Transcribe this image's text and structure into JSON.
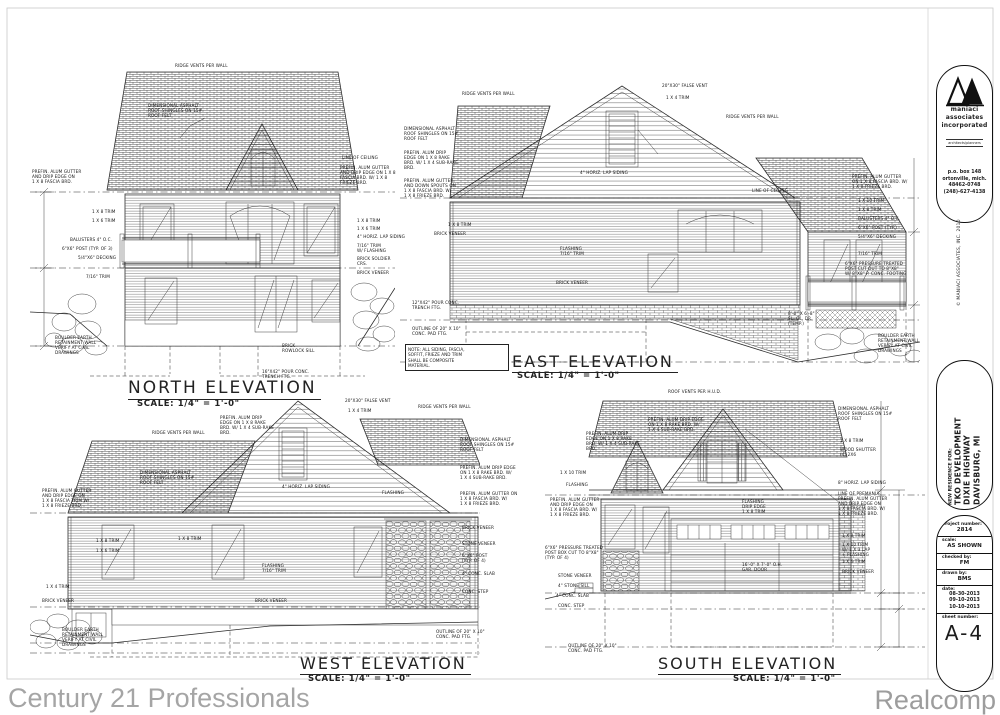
{
  "sheet": {
    "elevations": [
      {
        "id": "north",
        "title": "NORTH ELEVATION",
        "scale": "SCALE: 1/4\" = 1'-0\""
      },
      {
        "id": "east",
        "title": "EAST ELEVATION",
        "scale": "SCALE: 1/4\" = 1'-0\""
      },
      {
        "id": "west",
        "title": "WEST ELEVATION",
        "scale": "SCALE: 1/4\" = 1'-0\""
      },
      {
        "id": "south",
        "title": "SOUTH ELEVATION",
        "scale": "SCALE: 1/4\" = 1'-0\""
      }
    ],
    "note": "NOTE: ALL SIDING, FASCIA,\nSOFFIT, FRIEZE AND TRIM\nSHALL BE COMPOSITE\nMATERIAL."
  },
  "annotations": {
    "north": [
      {
        "t": "RIDGE VENTS PER WALL",
        "x": 175,
        "y": 64
      },
      {
        "t": "DIMENSIONAL ASPHALT\nROOF SHINGLES ON 15#\nROOF FELT",
        "x": 148,
        "y": 104
      },
      {
        "t": "LINE OF CEILING",
        "x": 342,
        "y": 156
      },
      {
        "t": "PREFIN. ALUM GUTTER\nAND DRIP EDGE ON 1 X 8\nFASCIA BRD. W/ 1 X 8\nFRIEZE BRD.",
        "x": 340,
        "y": 166
      },
      {
        "t": "PREFIN. ALUM GUTTER\nAND DRIP EDGE ON\n1 X 8 FASCIA BRD.",
        "x": 32,
        "y": 170
      },
      {
        "t": "1 X 8 TRIM",
        "x": 92,
        "y": 210
      },
      {
        "t": "1 X 6 TRIM",
        "x": 92,
        "y": 219
      },
      {
        "t": "BALUSTERS 4\" O.C.",
        "x": 70,
        "y": 238
      },
      {
        "t": "6\"X6\" POST (TYP. OF 3)",
        "x": 62,
        "y": 247
      },
      {
        "t": "5/4\"X6\" DECKING",
        "x": 78,
        "y": 256
      },
      {
        "t": "7/16\" TRIM",
        "x": 86,
        "y": 275
      },
      {
        "t": "1 X 8 TRIM",
        "x": 357,
        "y": 219
      },
      {
        "t": "1 X 6 TRIM",
        "x": 357,
        "y": 227
      },
      {
        "t": "4\" HORIZ. LAP SIDING",
        "x": 357,
        "y": 235
      },
      {
        "t": "7/16\" TRIM\nW/ FLASHING",
        "x": 357,
        "y": 244
      },
      {
        "t": "BRICK SOLDIER\nCRS.",
        "x": 357,
        "y": 257
      },
      {
        "t": "BRICK VENEER",
        "x": 357,
        "y": 271
      },
      {
        "t": "BRICK\nROWLOCK SILL",
        "x": 282,
        "y": 344
      },
      {
        "t": "16\"X42\" POUR CONC.\nTRENCH FTG.",
        "x": 262,
        "y": 370
      },
      {
        "t": "BOULDER EARTH\nRETAINMENT WALL\nVERIFY AT CIVIL\nDRAWINGS",
        "x": 55,
        "y": 336
      }
    ],
    "east": [
      {
        "t": "RIDGE VENTS PER WALL",
        "x": 462,
        "y": 92
      },
      {
        "t": "20\"X30\" FALSE VENT",
        "x": 662,
        "y": 84
      },
      {
        "t": "1 X 4 TRIM",
        "x": 666,
        "y": 96
      },
      {
        "t": "RIDGE VENTS PER WALL",
        "x": 726,
        "y": 115
      },
      {
        "t": "DIMENSIONAL ASPHALT\nROOF SHINGLES ON 15#\nROOF FELT",
        "x": 404,
        "y": 127
      },
      {
        "t": "PREFIN. ALUM DRIP\nEDGE ON 1 X 8 RAKE\nBRD. W/ 1 X 4 SUB-RAKE\nBRD.",
        "x": 404,
        "y": 151
      },
      {
        "t": "PREFIN. ALUM GUTTER\nAND DOWN SPOUTS ON\n1 X 8 FASCIA BRD. W/\n1 X 8 FRIEZE BRD.",
        "x": 404,
        "y": 179
      },
      {
        "t": "4\" HORIZ. LAP SIDING",
        "x": 580,
        "y": 171
      },
      {
        "t": "LINE OF CEILING",
        "x": 752,
        "y": 189
      },
      {
        "t": "1 X 8 TRIM",
        "x": 448,
        "y": 223
      },
      {
        "t": "BRICK VENEER",
        "x": 434,
        "y": 232
      },
      {
        "t": "FLASHING\n7/16\" TRIM",
        "x": 560,
        "y": 247
      },
      {
        "t": "BRICK VENEER",
        "x": 556,
        "y": 281
      },
      {
        "t": "12\"X42\" POUR CONC.\nTRENCH FTG.",
        "x": 412,
        "y": 301
      },
      {
        "t": "OUTLINE OF 20\" X 10\"\nCONC. PAD FTG.",
        "x": 412,
        "y": 327
      },
      {
        "t": "PREFIN. ALUM GUTTER\nON 1 X 8 FASCIA BRD. W/\n1 X 8 FRIEZE BRD.",
        "x": 852,
        "y": 175
      },
      {
        "t": "1 X 10 TRIM",
        "x": 858,
        "y": 199
      },
      {
        "t": "1 X 8 TRIM",
        "x": 858,
        "y": 208
      },
      {
        "t": "BALUSTERS 4\" O.C.",
        "x": 858,
        "y": 217
      },
      {
        "t": "6\"X6\" POST (TYP.)",
        "x": 858,
        "y": 226
      },
      {
        "t": "5/4\"X6\" DECKING",
        "x": 858,
        "y": 235
      },
      {
        "t": "7/16\" TRIM",
        "x": 858,
        "y": 252
      },
      {
        "t": "6\"X6\" PRESSURE TREATED\nPOST CUT OUT TO 8\"X8\"\nW/ 8\"X8\" P. CONC. FOOTING",
        "x": 845,
        "y": 262
      },
      {
        "t": "8'-0\" X 6'-8\"\nSL. GL. DR.\n(TEMP.)",
        "x": 788,
        "y": 312
      },
      {
        "t": "BOULDER EARTH\nRETAINMENT WALL\nVERIFY AT CIVIL\nDRAWINGS",
        "x": 878,
        "y": 334
      }
    ],
    "west": [
      {
        "t": "RIDGE VENTS PER WALL",
        "x": 152,
        "y": 431
      },
      {
        "t": "PREFIN. ALUM DRIP\nEDGE ON 1 X 8 RAKE\nBRD. W/ 1 X 4 SUB-RAKE\nBRD.",
        "x": 220,
        "y": 416
      },
      {
        "t": "20\"X30\" FALSE VENT",
        "x": 345,
        "y": 399
      },
      {
        "t": "1 X 4 TRIM",
        "x": 348,
        "y": 409
      },
      {
        "t": "RIDGE VENTS PER WALL",
        "x": 418,
        "y": 405
      },
      {
        "t": "DIMENSIONAL ASPHALT\nROOF SHINGLES ON 15#\nROOF FELT",
        "x": 140,
        "y": 471
      },
      {
        "t": "PREFIN. ALUM GUTTER\nAND DRIP EDGE ON\n1 X 8 FASCIA TRIM W/\n1 X 8 FRIEZE BRD.",
        "x": 42,
        "y": 489
      },
      {
        "t": "4\" HORIZ. LAP SIDING",
        "x": 282,
        "y": 485
      },
      {
        "t": "FLASHING",
        "x": 382,
        "y": 491
      },
      {
        "t": "1 X 8 TRIM",
        "x": 96,
        "y": 539
      },
      {
        "t": "1 X 6 TRIM",
        "x": 96,
        "y": 549
      },
      {
        "t": "1 X 8 TRIM",
        "x": 178,
        "y": 537
      },
      {
        "t": "FLASHING\n7/16\" TRIM",
        "x": 262,
        "y": 564
      },
      {
        "t": "BRICK VENEER",
        "x": 255,
        "y": 599
      },
      {
        "t": "1 X 4 TRIM",
        "x": 46,
        "y": 585
      },
      {
        "t": "BRICK VENEER",
        "x": 42,
        "y": 599
      },
      {
        "t": "DIMENSIONAL ASPHALT\nROOF SHINGLES ON 15#\nROOF FELT",
        "x": 460,
        "y": 438
      },
      {
        "t": "PREFIN. ALUM DRIP EDGE\nON 1 X 8 RAKE BRD. W/\n1 X 4 SUB-RAKE BRD.",
        "x": 460,
        "y": 466
      },
      {
        "t": "PREFIN. ALUM GUTTER ON\n1 X 8 FASCIA BRD. W/\n1 X 8 FRIEZE BRD.",
        "x": 460,
        "y": 492
      },
      {
        "t": "BRICK VENEER",
        "x": 462,
        "y": 526
      },
      {
        "t": "STONE VENEER",
        "x": 462,
        "y": 542
      },
      {
        "t": "6\"X6\" POST\n(TYP. OF 4)",
        "x": 462,
        "y": 554
      },
      {
        "t": "4\" CONC. SLAB",
        "x": 462,
        "y": 572
      },
      {
        "t": "CONC. STEP",
        "x": 462,
        "y": 590
      },
      {
        "t": "BOULDER EARTH\nRETAINMENT WALL\nVERIFY AT CIVIL\nDRAWINGS",
        "x": 62,
        "y": 628
      },
      {
        "t": "OUTLINE OF 20\" X 10\"\nCONC. PAD FTG.",
        "x": 436,
        "y": 630
      }
    ],
    "south": [
      {
        "t": "ROOF VENTS PER H.U.D.",
        "x": 668,
        "y": 390
      },
      {
        "t": "DIMENSIONAL ASPHALT\nROOF SHINGLES ON 15#\nROOF FELT",
        "x": 838,
        "y": 407
      },
      {
        "t": "PREFIN. ALUM DRIP\nEDGE ON 1 X 8 RAKE\nBRD. W/ 1 X 4 SUB-RAKE\nBRD.",
        "x": 586,
        "y": 432
      },
      {
        "t": "PREFIN. ALUM DRIP EDGE\nON 1 X 8 RAKE BRD. W/\n1 X 4 SUB-RAKE BRD.",
        "x": 648,
        "y": 418
      },
      {
        "t": "1 X 8 TRIM",
        "x": 840,
        "y": 439
      },
      {
        "t": "WOOD SHUTTER\n(4) 2X6",
        "x": 840,
        "y": 448
      },
      {
        "t": "8\" HORIZ. LAP SIDING",
        "x": 838,
        "y": 481
      },
      {
        "t": "LINE OF PREMANUF.\nPREFIN. ALUM GUTTER\nAND DRIP EDGE ON\n1 X 8 FASCIA BRD. W/\n1 X 8 FRIEZE BRD.",
        "x": 838,
        "y": 492
      },
      {
        "t": "1 X 10 TRIM",
        "x": 560,
        "y": 471
      },
      {
        "t": "FLASHING",
        "x": 566,
        "y": 483
      },
      {
        "t": "PREFIN. ALUM GUTTER\nAND DRIP EDGE ON\n1 X 8 FASCIA BRD. W/\n1 X 8 FRIEZE BRD.",
        "x": 550,
        "y": 498
      },
      {
        "t": "FLASHING\nDRIP EDGE\n1 X 8 TRIM",
        "x": 742,
        "y": 500
      },
      {
        "t": "1 X 8 TRIM",
        "x": 842,
        "y": 534
      },
      {
        "t": "1 X 10 TRIM\nW/ 1 X 3 LAP\n+ FLASHING",
        "x": 842,
        "y": 543
      },
      {
        "t": "1 X 6 TRIM",
        "x": 842,
        "y": 560
      },
      {
        "t": "BRICK VENEER",
        "x": 842,
        "y": 570
      },
      {
        "t": "6\"X6\" PRESSURE TREATED\nPOST BOX CUT TO 8\"X8\"\n(TYP. OF 4)",
        "x": 545,
        "y": 546
      },
      {
        "t": "STONE VENEER",
        "x": 558,
        "y": 574
      },
      {
        "t": "4\" STONE SILL",
        "x": 558,
        "y": 584
      },
      {
        "t": "4\" CONC. SLAB",
        "x": 556,
        "y": 594
      },
      {
        "t": "CONC. STEP",
        "x": 558,
        "y": 604
      },
      {
        "t": "16'-0\" X 7'-0\" O.H.\nGAR. DOOR",
        "x": 742,
        "y": 563
      },
      {
        "t": "OUTLINE OF 20\" X 10\"\nCONC. PAD FTG.",
        "x": 568,
        "y": 644
      }
    ]
  },
  "titleblock": {
    "logo": "maniaci-triangles-logo",
    "firm_lines": [
      "maniaci",
      "associates",
      "incorporated"
    ],
    "firm_tagline": "architects/planners",
    "address_lines": [
      "p.o. box 148",
      "ortonville, mich.",
      "48462-0748",
      "(248)-627-4138"
    ],
    "copyright": "© MANIACI ASSOCIATES, INC. 2010",
    "project_label": "NEW RESIDENCE FOR:",
    "project_lines": [
      "TKO DEVELOPMENT",
      "DIXIE HIGHWAY",
      "DAVISBURG, MI"
    ],
    "fields": [
      {
        "label": "project number:",
        "value": "2814"
      },
      {
        "label": "scale:",
        "value": "AS SHOWN"
      },
      {
        "label": "checked by:",
        "value": "FM"
      },
      {
        "label": "drawn by:",
        "value": "BMS"
      },
      {
        "label": "date:",
        "value": "08-30-2013\n09-10-2013\n10-10-2013"
      }
    ],
    "sheet_label": "sheet number:",
    "sheet_number": "A-4"
  },
  "watermarks": {
    "left": "Century 21 Professionals",
    "right": "Realcomp"
  }
}
